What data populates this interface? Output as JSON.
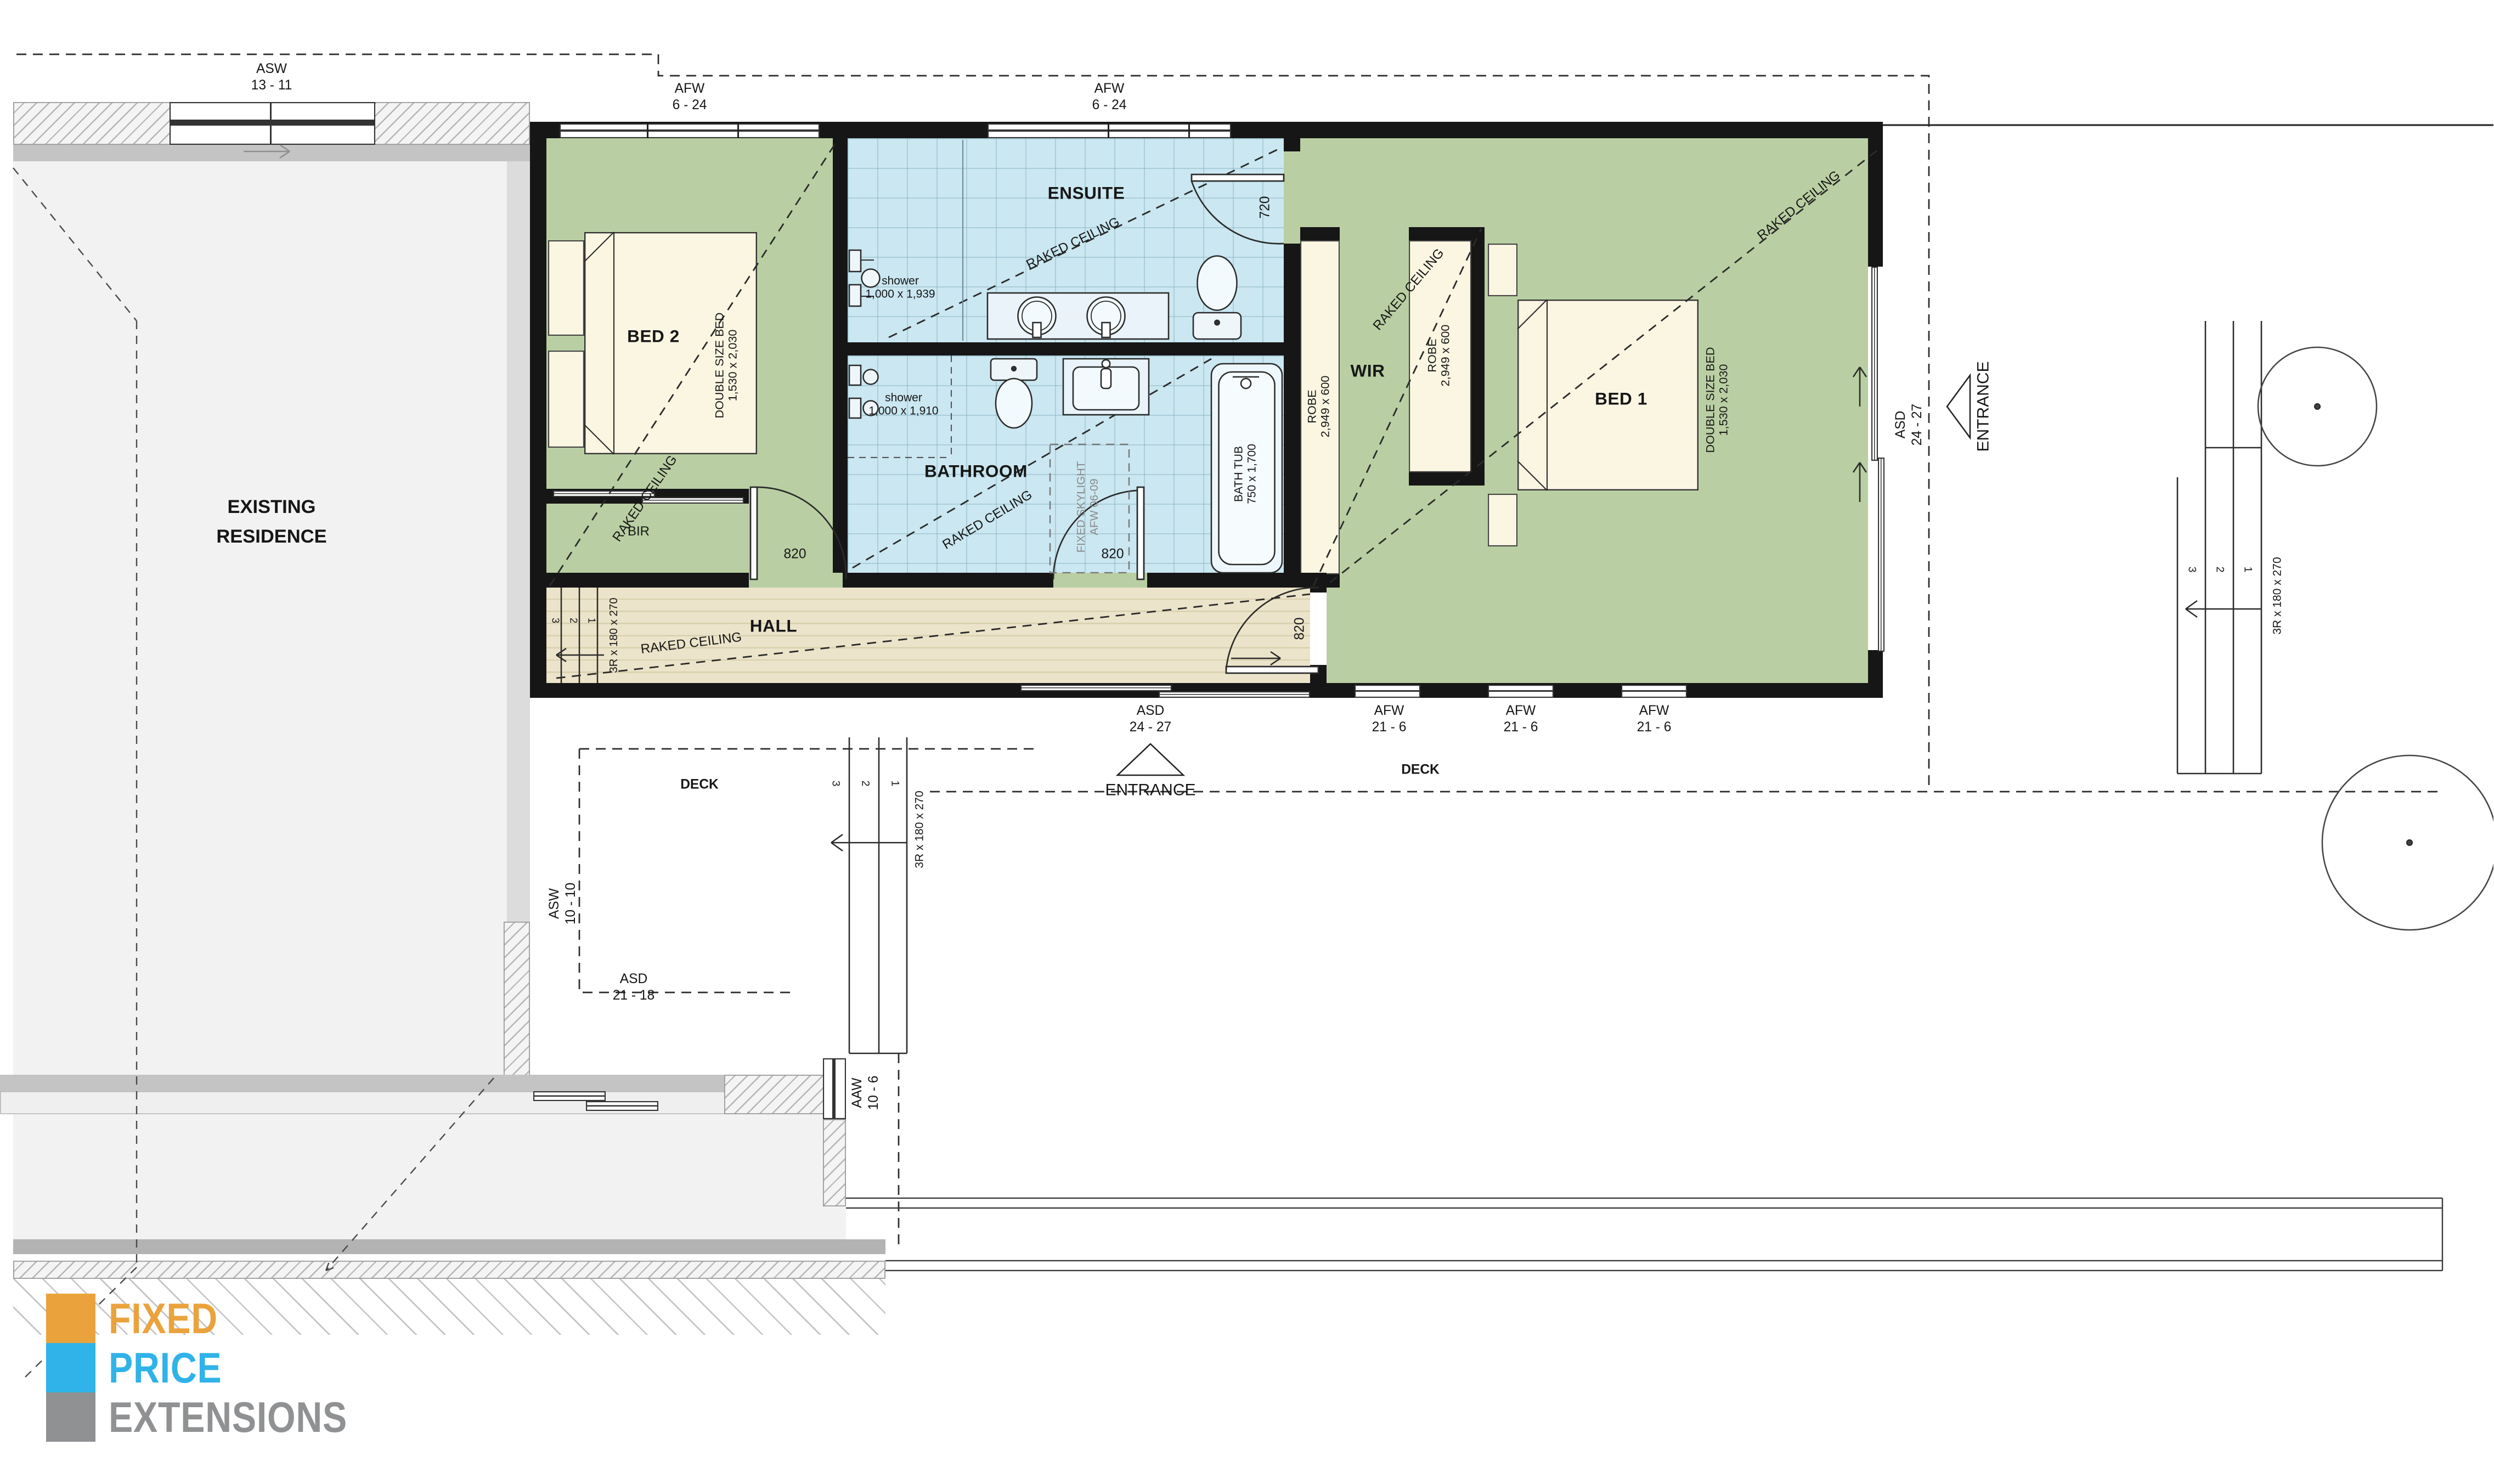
{
  "plan": {
    "title_block": {
      "existing_l1": "EXISTING",
      "existing_l2": "RESIDENCE"
    },
    "rooms": {
      "bed2": "BED 2",
      "bed1": "BED 1",
      "ensuite": "ENSUITE",
      "bathroom": "BATHROOM",
      "hall": "HALL",
      "wir": "WIR",
      "bir": "BIR",
      "deck": "DECK"
    },
    "notes": {
      "raked_ceiling": "RAKED CEILING",
      "entrance": "ENTRANCE"
    },
    "beds": {
      "dim_l1": "DOUBLE SIZE BED",
      "dim_l2": "1,530 x 2,030"
    },
    "robes": {
      "l1": "ROBE",
      "l2": "2,949 x 600"
    },
    "fixtures": {
      "shower_word": "shower",
      "shower_ensuite_dim": "1,000 x 1,939",
      "shower_bath_dim": "1,000 x 1,910",
      "bathtub_l1": "BATH TUB",
      "bathtub_l2": "750 x 1,700",
      "skylight_l1": "FIXED SKYLIGHT",
      "skylight_l2": "AFW 06-09"
    },
    "openings": {
      "asw_top_l1": "ASW",
      "asw_top_l2": "13 - 11",
      "afw_top_l1": "AFW",
      "afw_top_l2": "6 - 24",
      "asd_l1": "ASD",
      "asd_l2": "24 - 27",
      "afw_bot_l1": "AFW",
      "afw_bot_l2": "21 - 6",
      "asw_deck_l1": "ASW",
      "asw_deck_l2": "10 - 10",
      "asd_res_l1": "ASD",
      "asd_res_l2": "21 - 18",
      "aaw_l1": "AAW",
      "aaw_l2": "10 - 6",
      "door_820": "820",
      "door_720": "720"
    },
    "stairs": {
      "spec": "3R x 180 x 270",
      "n1": "1",
      "n2": "2",
      "n3": "3"
    }
  },
  "logo": {
    "line1": "FIXED",
    "line2": "PRICE",
    "line3": "EXTENSIONS",
    "color1": "#eaa33c",
    "color2": "#2fb3e8",
    "color3": "#8f9193"
  }
}
